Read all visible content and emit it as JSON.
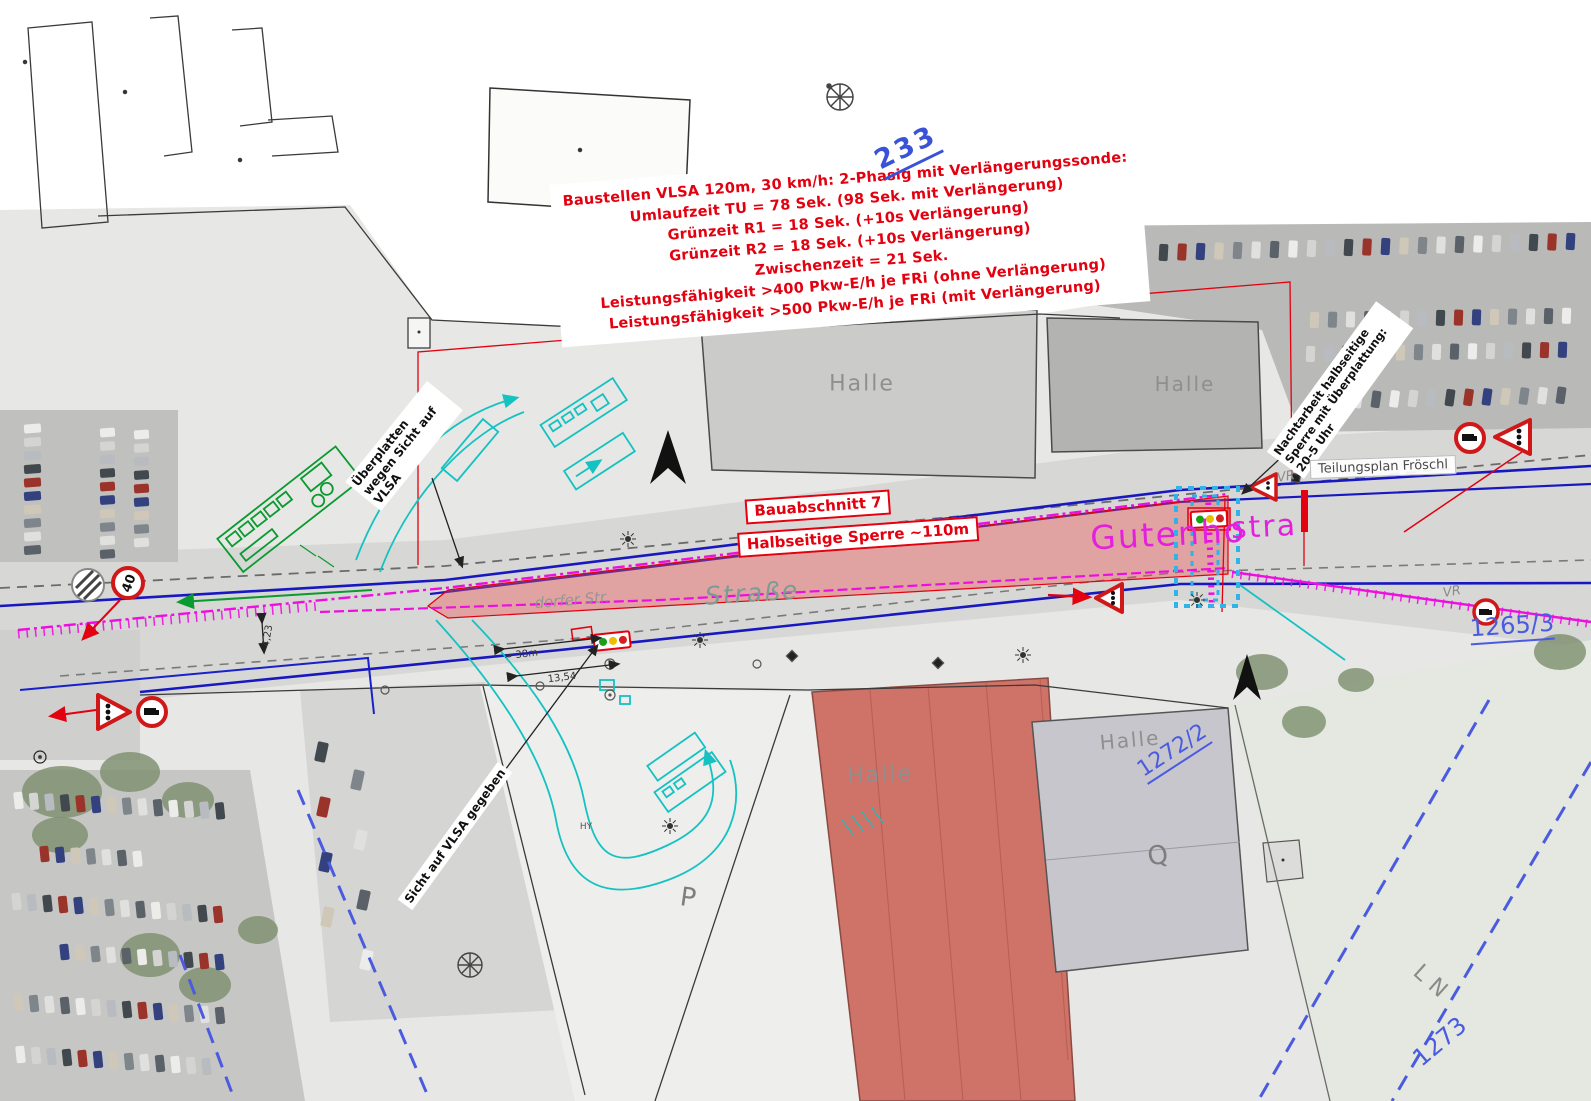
{
  "sheet": {
    "number": "233"
  },
  "notes": {
    "lines": [
      "Baustellen VLSA 120m, 30 km/h: 2-Phasig mit Verlängerungssonde:",
      "Umlaufzeit TU = 78 Sek. (98 Sek. mit Verlängerung)",
      "Grünzeit R1 = 18 Sek. (+10s Verlängerung)",
      "Grünzeit R2 = 18 Sek. (+10s Verlängerung)",
      "Zwischenzeit = 21 Sek.",
      "Leistungsfähigkeit >400 Pkw-E/h je FRi (ohne Verlängerung)",
      "Leistungsfähigkeit >500 Pkw-E/h je FRi (mit Verlängerung)"
    ]
  },
  "labels": {
    "bauabschnitt": "Bauabschnitt 7",
    "sperre": "Halbseitige Sperre ~110m",
    "ueberplatten": "Überplatten wegen Sicht auf VLSA",
    "nachtarbeit": "Nachtarbeit halbseitige Sperre mit Überplattung: 20-5 Uhr",
    "sicht_gegeben": "Sicht auf VLSA gegeben",
    "teilungsplan": "Teilungsplan Fröschl"
  },
  "streets": {
    "magenta_left": "Gutenho",
    "magenta_right": "stra",
    "gray_big": "Straße",
    "gray_small": "dorfer Str."
  },
  "map_text": {
    "halle": "Halle",
    "p": "P",
    "q": "Q",
    "ln": "LN",
    "vr": "VR",
    "hy": "HY"
  },
  "parcels": {
    "a": "1265/3",
    "b": "1272/2",
    "c": "1273"
  },
  "signs": {
    "speed_limit": "40"
  },
  "dimensions": {
    "width_1": "13,54",
    "length_1": "≈ 38m",
    "width_2": "4,23"
  },
  "colors": {
    "cad_red": "#e3000f",
    "cad_blue": "#1818c0",
    "cad_magenta": "#ec0fe0",
    "cad_cyan": "#14c2c2",
    "cad_green": "#0a9a30",
    "parcel_blue": "#4a5be0",
    "photo_gray": "#e7e7e5"
  }
}
